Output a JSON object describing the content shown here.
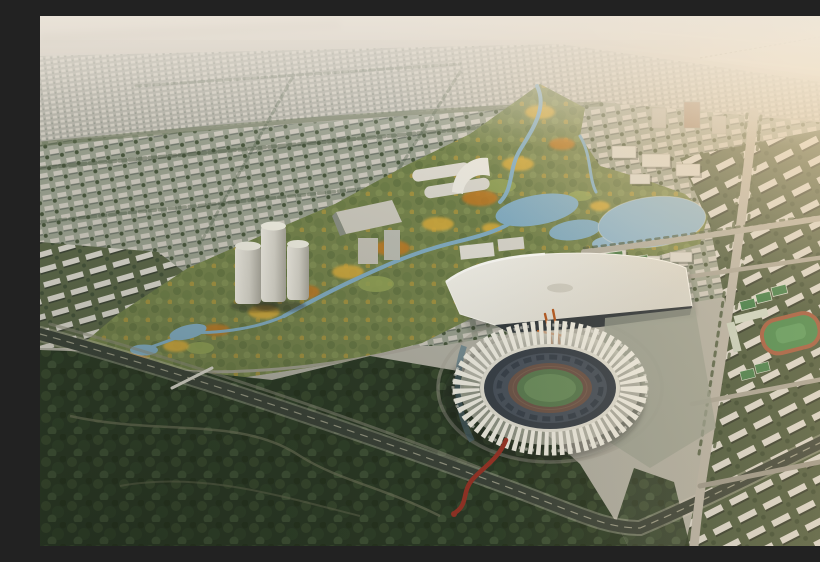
{
  "meta": {
    "type": "aerial-architectural-rendering",
    "description": "Bird's-eye masterplan rendering of a new city district at hazy golden hour: a dense low-rise cityscape recedes to a misty horizon with a distant river bridge; a diagonal green park corridor with winding blue streams, ponds and autumn-gold trees runs through the center; a white ring stadium with radiating roof fins sits beside a long white-roofed exhibition center; cylindrical white towers mark a small CBD; gridded white residential slabs fill the right; a dark forest belt and a diagonal highway cross the lower left; warm sunlight glows from the upper right."
  },
  "scene": {
    "elements": [
      {
        "name": "hazy-horizon",
        "desc": "pale warm haze with distant river and long bridge"
      },
      {
        "name": "far-cityscape",
        "desc": "dense small gray blocks receding to horizon"
      },
      {
        "name": "mid-cityscape",
        "desc": "gray-green urban fabric with tree-lined boulevards"
      },
      {
        "name": "left-residential-slabs",
        "desc": "rows of white slab apartment blocks"
      },
      {
        "name": "right-residential-grid",
        "desc": "tilted rows of white slabs with green courtyards"
      },
      {
        "name": "central-park-corridor",
        "desc": "green corridor with lawns and autumn trees"
      },
      {
        "name": "winding-river",
        "desc": "blue stream meandering through the park"
      },
      {
        "name": "west-pond",
        "desc": "irregular pond in mid park"
      },
      {
        "name": "east-lake",
        "desc": "large blue lake east of the park"
      },
      {
        "name": "cbd-towers",
        "desc": "three white cylindrical towers with podium arcs"
      },
      {
        "name": "exhibition-center",
        "desc": "long white sweeping roof with dark glass band"
      },
      {
        "name": "stadium",
        "desc": "ring stadium, white radial fins, dark bowl, green pitch with track"
      },
      {
        "name": "red-ribbon-path",
        "desc": "red winding pedestrian ribbon south-west of stadium"
      },
      {
        "name": "school-sports-fields",
        "desc": "green pitch with red track and small courts"
      },
      {
        "name": "forest-belt",
        "desc": "dark woodland across the lower left"
      },
      {
        "name": "highway",
        "desc": "dark diagonal expressway with center dashes"
      },
      {
        "name": "sun-glow",
        "desc": "warm light flooding from upper right"
      }
    ]
  },
  "palette": {
    "sky_top": "#d7d0c7",
    "sky_low": "#c2bcb1",
    "far_water": "#d8d2c9",
    "land_base": "#b2b0a4",
    "city_far": "#adaca2",
    "city_mid": "#9aa08f",
    "building_white": "#d8d5cb",
    "tree_dark": "#2c3a26",
    "boulevard_green": "#46553e",
    "park_green": "#75834d",
    "lawn": "#93a257",
    "autumn_gold": "#d7ab3c",
    "autumn_orange": "#bf7a28",
    "water": "#82abc0",
    "lake": "#8fb4c9",
    "road_dark": "#3d443a",
    "road_light": "#b7b2a6",
    "plaza": "#9ba092",
    "expo_roof": "#e9e6dd",
    "expo_glass": "#343a3e",
    "sculpture_orange": "#b65a22",
    "stadium_base": "#d6d3c7",
    "stadium_fin": "#f0ede2",
    "stadium_rim": "#e1ded2",
    "stadium_bowl": "#3a4149",
    "stadium_seats": "#4b535d",
    "stadium_track": "#6e5549",
    "stadium_pitch": "#5b7b51",
    "red_ribbon": "#9c3427",
    "court_green": "#4c8a50",
    "track_red": "#a35c41",
    "sun_glow": "#ffe9c4"
  }
}
